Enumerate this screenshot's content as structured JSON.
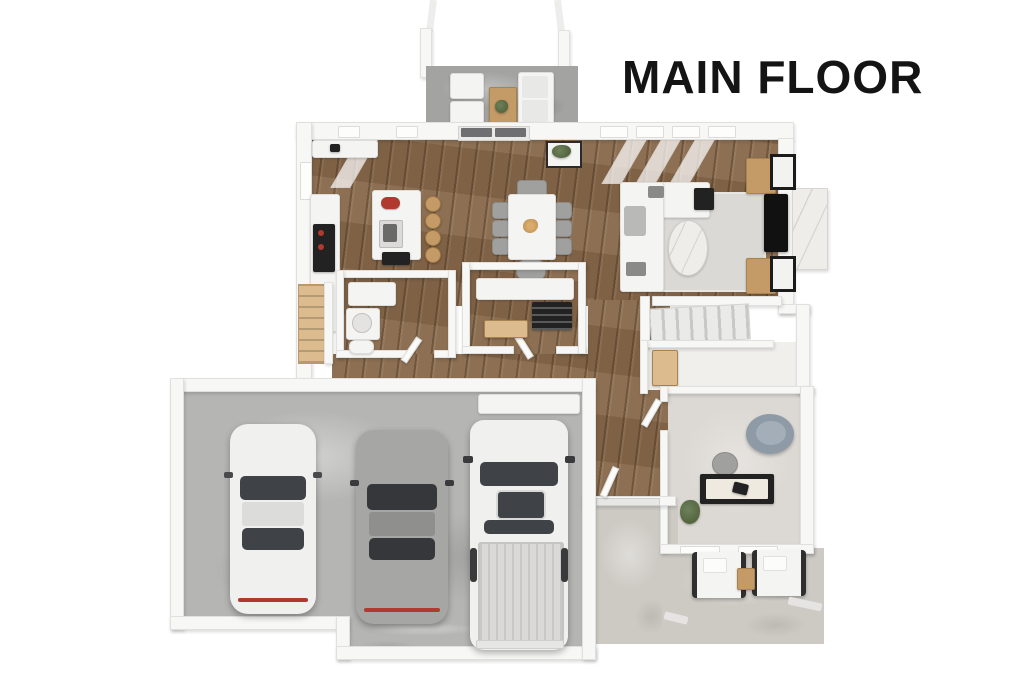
{
  "title": "MAIN FLOOR",
  "colors": {
    "background": "#ffffff",
    "title_text": "#141414",
    "wall": "#f7f7f6",
    "wall_edge": "#e0e0de",
    "wood_floor": "#87684a",
    "garage_floor": "#b5b5b3",
    "porch_floor": "#a3a3a1",
    "patio_floor": "#cdcac4",
    "office_floor": "#dcd8d3",
    "closet_floor": "#f0efec",
    "rug": "#dad9d5",
    "marble": "#eeede9",
    "wood_accent": "#c49a66",
    "stair_wood": "#dcbc8f",
    "dark": "#222222",
    "glass": "#3f4246",
    "car_white": "#f0f0ee",
    "car_gray": "#a6a6a4",
    "red": "#b03a2e",
    "chair_gray": "#a0a09e",
    "sofa_white": "#f4f4f2",
    "round_chair": "#8e9ba7",
    "plant_green": "#54663f"
  },
  "scene": {
    "view": "3d-birds-eye-floor-plan",
    "rooms": [
      "front-porch",
      "kitchen",
      "dining-area",
      "living-room",
      "entry",
      "powder-bathroom",
      "pantry-laundry",
      "basement-stairs",
      "hallway",
      "staircase",
      "mudroom-closet",
      "office-den",
      "rear-patio",
      "garage"
    ],
    "furniture": {
      "front_porch": [
        "armchair",
        "armchair",
        "coffee-table",
        "sofa",
        "columns-x2"
      ],
      "kitchen": [
        "wall-counter",
        "cooktop",
        "kitchen-island",
        "island-sink",
        "bar-stools-x4",
        "red-kettle"
      ],
      "dining_area": [
        "dining-table",
        "dining-chairs-x8",
        "centerpiece"
      ],
      "living_room": [
        "sectional-sofa",
        "area-rug",
        "oval-coffee-table",
        "tv",
        "media-cabinets-x2",
        "wall-art-x2",
        "fireplace-bump-out",
        "side-table"
      ],
      "powder_bathroom": [
        "cabinet",
        "vanity-sink",
        "toilet"
      ],
      "pantry_laundry": [
        "marble-counter",
        "dark-shelving",
        "wood-drawer-bench"
      ],
      "office_den": [
        "desk",
        "laptop",
        "desk-chair",
        "round-lounge-chair",
        "plant"
      ],
      "rear_patio": [
        "patio-chair",
        "patio-chair",
        "side-table",
        "step-stones"
      ],
      "garage": [
        "white-sedan",
        "gray-sedan",
        "white-pickup-truck",
        "storage-bench"
      ]
    },
    "vehicle_count": 3
  }
}
